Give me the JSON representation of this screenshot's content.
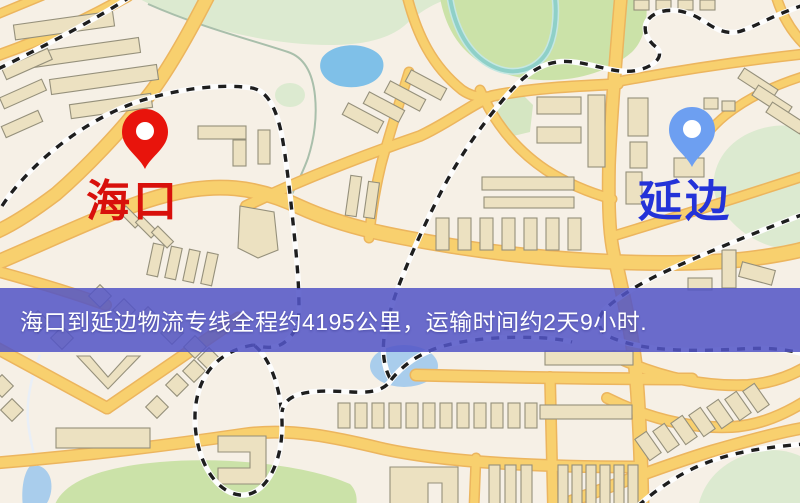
{
  "banner": {
    "text": "海口到延边物流专线全程约4195公里，运输时间约2天9小时.",
    "background_color": "#5355c6",
    "text_color": "#ffffff"
  },
  "markers": {
    "origin": {
      "label": "海口",
      "pin_color": "#e8140c",
      "label_color": "#d8100b"
    },
    "destination": {
      "label": "延边",
      "pin_color": "#6d9ff1",
      "label_color": "#2433d8"
    }
  },
  "route": {
    "from": "海口",
    "to": "延边",
    "distance_km": "4195",
    "duration_text": "2天9小时"
  },
  "map_palette": {
    "background": "#f6f0e6",
    "road_fill": "#f8d06e",
    "road_casing": "#ecb55e",
    "building_fill": "#ece1c1",
    "building_outline": "#95907b",
    "park_green": "#cbe2a8",
    "park_light_green": "#dcead0",
    "lake_blue": "#7fc0e8",
    "water_blue": "#a9cdec",
    "railway_dark": "#1e1e1e"
  }
}
